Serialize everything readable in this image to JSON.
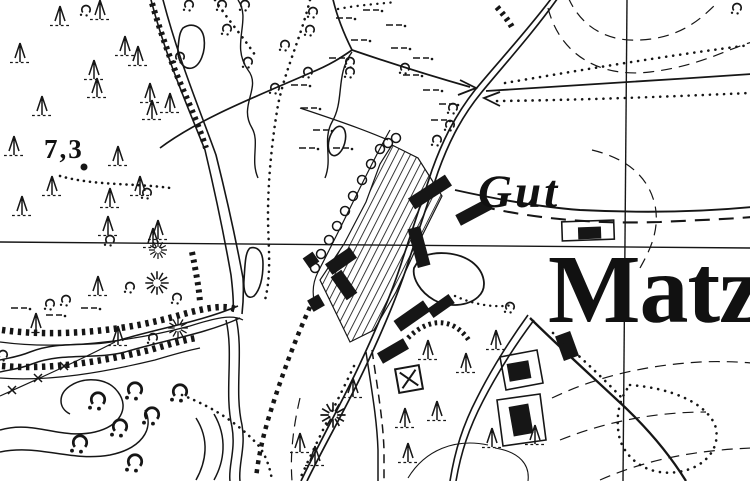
{
  "map": {
    "type": "historical-topographic-map-scan",
    "labels": {
      "spot_height": "7,3",
      "estate": "Gut",
      "settlement": "Matz"
    },
    "colors": {
      "ink": "#161616",
      "paper": "#ffffff"
    },
    "symbols": [
      "conifer-tree",
      "bush",
      "meadow-mark",
      "sand-pit",
      "chapel-square",
      "building",
      "hatched-garden",
      "stream",
      "road",
      "contour-line",
      "grid-line",
      "dotted-path",
      "bank-hachure"
    ]
  }
}
